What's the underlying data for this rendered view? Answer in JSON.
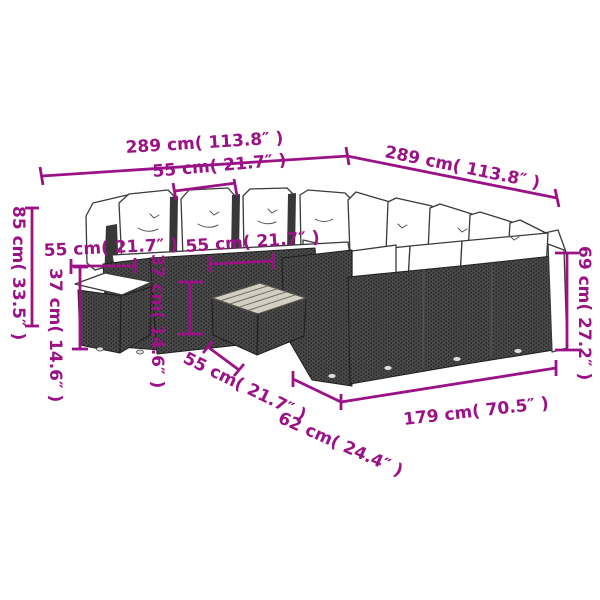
{
  "colors": {
    "dimension_accent": "#9B1286",
    "rattan_dark": "#4a4a4a",
    "line_art": "#3a3a3a",
    "table_top": "#d2cec2"
  },
  "diagram": {
    "illustration": "poly-rattan-garden-lounge-set-line-drawing",
    "dimensions": [
      {
        "id": "overall-width-front",
        "label": "289 cm( 113.8″ )"
      },
      {
        "id": "overall-depth-right",
        "label": "289 cm( 113.8″ )"
      },
      {
        "id": "seat-module-width",
        "label": "55 cm( 21.7″ )"
      },
      {
        "id": "ottoman-width",
        "label": "55 cm( 21.7″ )"
      },
      {
        "id": "table-width",
        "label": "55 cm( 21.7″ )"
      },
      {
        "id": "table-depth",
        "label": "55 cm( 21.7″ )"
      },
      {
        "id": "ottoman-height",
        "label": "37 cm( 14.6″ )"
      },
      {
        "id": "table-height",
        "label": "37 cm( 14.6″ )"
      },
      {
        "id": "back-height-left",
        "label": "85 cm( 33.5″ )"
      },
      {
        "id": "back-height-right",
        "label": "69 cm( 27.2″ )"
      },
      {
        "id": "seat-depth",
        "label": "62 cm( 24.4″ )"
      },
      {
        "id": "sofa-length",
        "label": "179 cm( 70.5″ )"
      }
    ]
  }
}
